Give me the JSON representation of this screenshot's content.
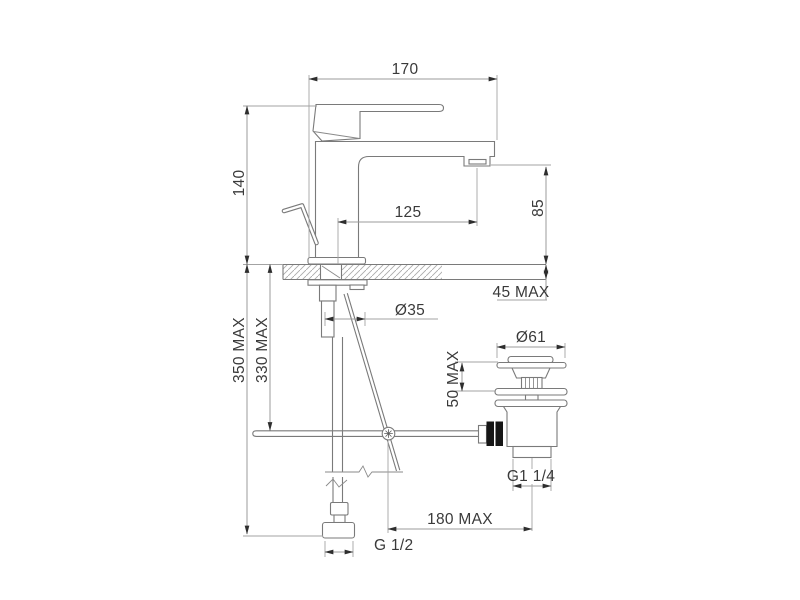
{
  "drawing": {
    "type": "technical-dimension-drawing",
    "background_color": "#ffffff",
    "colors": {
      "part_outline": "#7a7a7a",
      "dimension_line": "#9b9b9b",
      "text": "#3a3a3a",
      "arrowhead": "#2e2e2e",
      "connector_black": "#161616",
      "hatch": "#ababab"
    },
    "labels": {
      "total_width": "170",
      "body_height": "140",
      "spout_reach": "125",
      "spout_height": "85",
      "deck_thickness_max": "45 MAX",
      "shank_diameter": "Ø35",
      "hose_length_max": "350 MAX",
      "rod_drop_max": "330 MAX",
      "waste_flange_diameter": "Ø61",
      "waste_clamp_max": "50 MAX",
      "waste_thread": "G1 1/4",
      "rod_reach_max": "180 MAX",
      "supply_thread": "G 1/2"
    }
  }
}
